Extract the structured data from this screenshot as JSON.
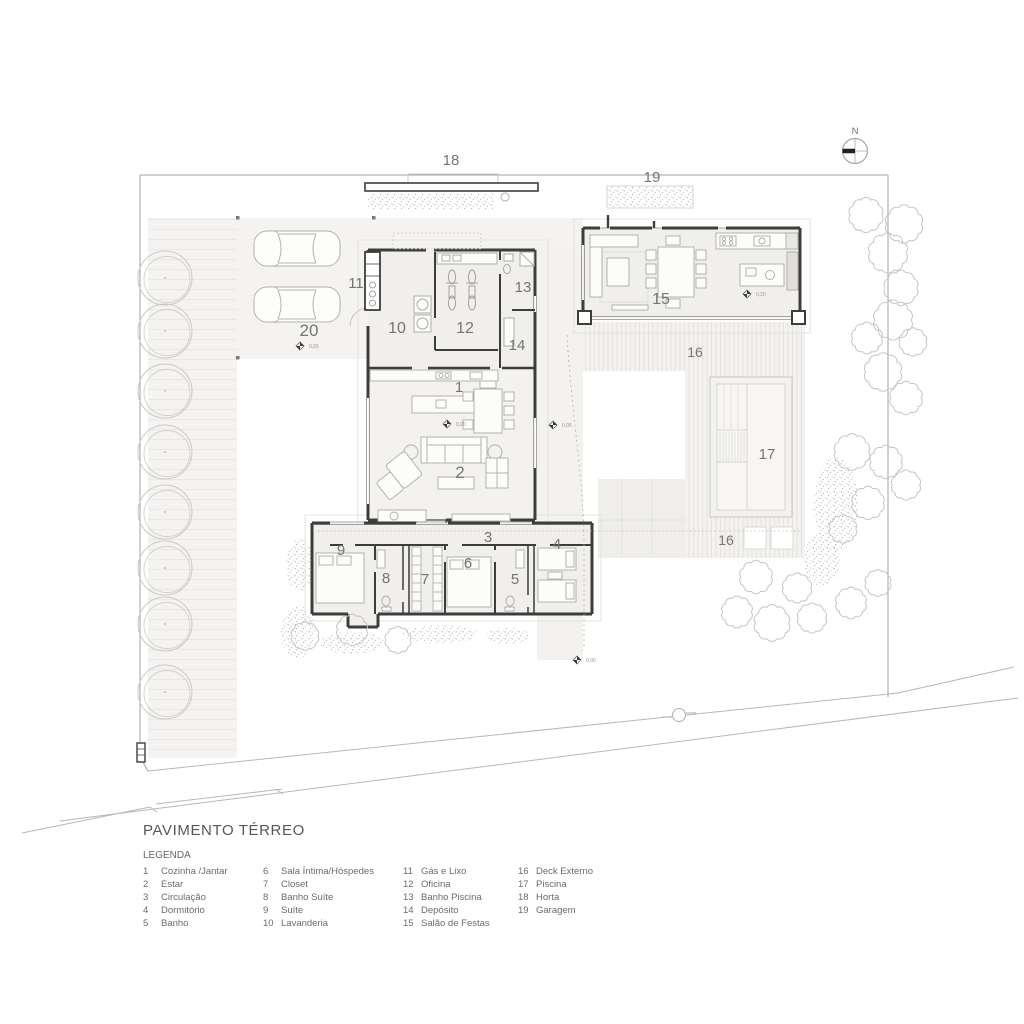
{
  "title": "PAVIMENTO TÉRREO",
  "legend": {
    "heading": "LEGENDA",
    "columns": [
      {
        "items": [
          {
            "num": "1",
            "label": "Cozinha /Jantar"
          },
          {
            "num": "2",
            "label": "Estar"
          },
          {
            "num": "3",
            "label": "Circulação"
          },
          {
            "num": "4",
            "label": "Dormitório"
          },
          {
            "num": "5",
            "label": "Banho"
          }
        ]
      },
      {
        "items": [
          {
            "num": "6",
            "label": "Sala Íntima/Hóspedes"
          },
          {
            "num": "7",
            "label": "Closet"
          },
          {
            "num": "8",
            "label": "Banho Suíte"
          },
          {
            "num": "9",
            "label": "Suíte"
          },
          {
            "num": "10",
            "label": "Lavanderia"
          }
        ]
      },
      {
        "items": [
          {
            "num": "11",
            "label": "Gás e Lixo"
          },
          {
            "num": "12",
            "label": "Oficina"
          },
          {
            "num": "13",
            "label": "Banho Piscina"
          },
          {
            "num": "14",
            "label": "Depósito"
          },
          {
            "num": "15",
            "label": "Salão de Festas"
          }
        ]
      },
      {
        "items": [
          {
            "num": "16",
            "label": "Deck Externo"
          },
          {
            "num": "17",
            "label": "Piscina"
          },
          {
            "num": "18",
            "label": "Horta"
          },
          {
            "num": "19",
            "label": "Garagem"
          }
        ]
      }
    ]
  },
  "compass": {
    "label": "N"
  },
  "plan": {
    "room_labels": [
      {
        "name": "horta",
        "text": "18",
        "x": 451,
        "y": 165,
        "size": 15
      },
      {
        "name": "garagem",
        "text": "19",
        "x": 652,
        "y": 182,
        "size": 15
      },
      {
        "name": "gas-e-lixo",
        "text": "11",
        "x": 356,
        "y": 288,
        "size": 15
      },
      {
        "name": "banho-piscina",
        "text": "13",
        "x": 523,
        "y": 292,
        "size": 15
      },
      {
        "name": "lavanderia",
        "text": "10",
        "x": 397,
        "y": 333,
        "size": 16
      },
      {
        "name": "oficina",
        "text": "12",
        "x": 465,
        "y": 333,
        "size": 16
      },
      {
        "name": "patio-carros",
        "text": "20",
        "x": 309,
        "y": 336,
        "size": 17
      },
      {
        "name": "deposito",
        "text": "14",
        "x": 517,
        "y": 350,
        "size": 15
      },
      {
        "name": "salao-de-festas",
        "text": "15",
        "x": 661,
        "y": 304,
        "size": 16
      },
      {
        "name": "deck-externo-1",
        "text": "16",
        "x": 695,
        "y": 357,
        "size": 14
      },
      {
        "name": "cozinha-jantar",
        "text": "1",
        "x": 459,
        "y": 392,
        "size": 15
      },
      {
        "name": "estar",
        "text": "2",
        "x": 460,
        "y": 478,
        "size": 17
      },
      {
        "name": "piscina",
        "text": "17",
        "x": 767,
        "y": 459,
        "size": 15
      },
      {
        "name": "deck-externo-2",
        "text": "16",
        "x": 726,
        "y": 545,
        "size": 14
      },
      {
        "name": "suite",
        "text": "9",
        "x": 341,
        "y": 555,
        "size": 15
      },
      {
        "name": "circulacao",
        "text": "3",
        "x": 488,
        "y": 542,
        "size": 15
      },
      {
        "name": "dormitorio",
        "text": "4",
        "x": 557,
        "y": 549,
        "size": 15
      },
      {
        "name": "sala-intima",
        "text": "6",
        "x": 468,
        "y": 568,
        "size": 15
      },
      {
        "name": "banho-suite",
        "text": "8",
        "x": 386,
        "y": 583,
        "size": 15
      },
      {
        "name": "closet",
        "text": "7",
        "x": 425,
        "y": 584,
        "size": 15
      },
      {
        "name": "banho",
        "text": "5",
        "x": 515,
        "y": 584,
        "size": 15
      }
    ],
    "level_markers": [
      {
        "value": "0,05",
        "x": 296,
        "y": 342
      },
      {
        "value": "0,20",
        "x": 443,
        "y": 420
      },
      {
        "value": "0,05",
        "x": 549,
        "y": 421
      },
      {
        "value": "0,20",
        "x": 743,
        "y": 290
      },
      {
        "value": "0,00",
        "x": 573,
        "y": 656
      }
    ]
  }
}
